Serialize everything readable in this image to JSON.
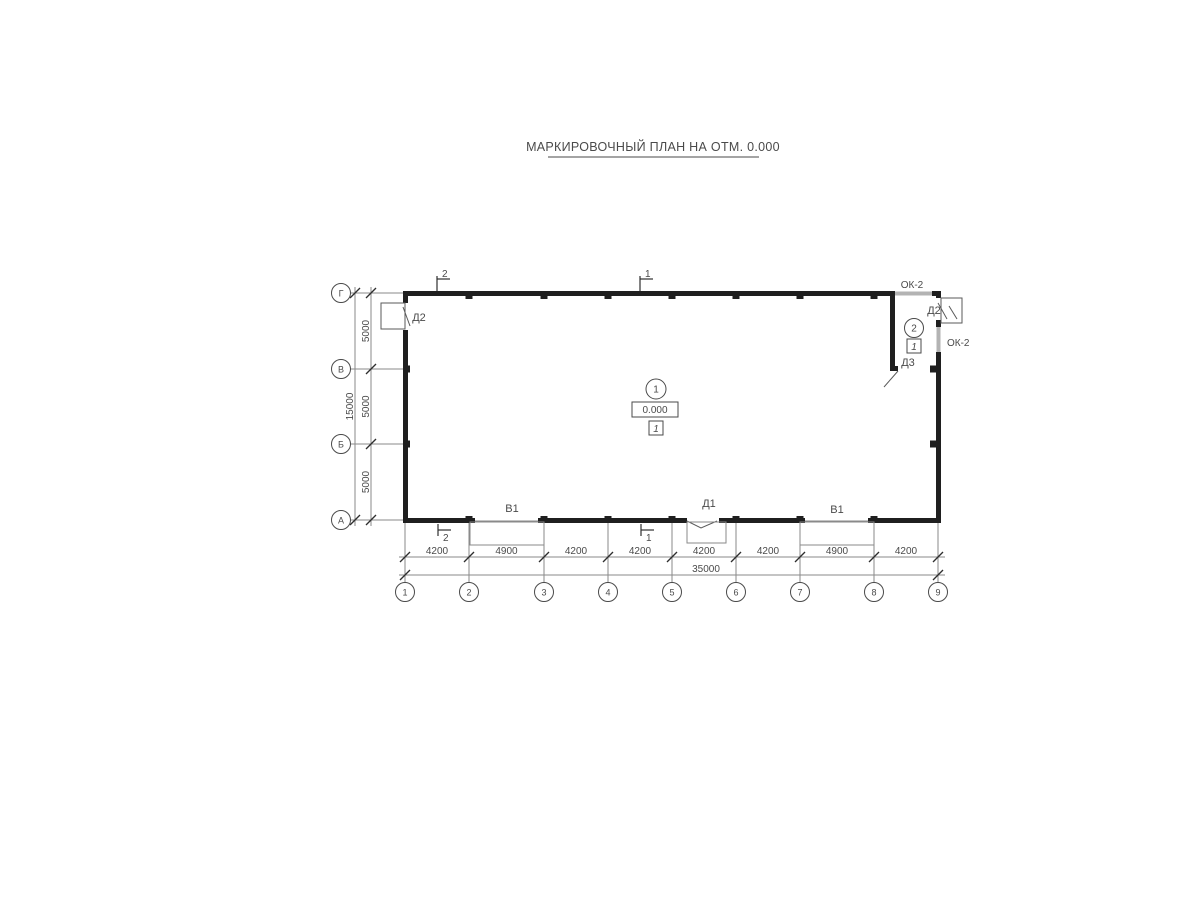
{
  "title": "МАРКИРОВОЧНЫЙ ПЛАН НА ОТМ. 0.000",
  "colors": {
    "wall": "#1f1f1f",
    "window": "#b3b3b3",
    "thin_line": "#8a8a8a",
    "text": "#4a4a4a"
  },
  "grid": {
    "columns": [
      "1",
      "2",
      "3",
      "4",
      "5",
      "6",
      "7",
      "8",
      "9"
    ],
    "rows": [
      "Г",
      "В",
      "Б",
      "А"
    ]
  },
  "dimensions": {
    "bottom": {
      "segments": [
        "4200",
        "4900",
        "4200",
        "4200",
        "4200",
        "4200",
        "4900",
        "4200"
      ],
      "total": "35000"
    },
    "left": {
      "segments": [
        "5000",
        "5000",
        "5000"
      ],
      "total": "15000"
    }
  },
  "sections": {
    "s1": "1",
    "s2": "2"
  },
  "openings": {
    "door_left": "Д2",
    "door_right": "Д2",
    "door_inner": "Д3",
    "door_front": "Д1",
    "gate_left": "В1",
    "gate_right": "В1",
    "window_top": "ОК-2",
    "window_side": "ОК-2"
  },
  "rooms": {
    "hall": {
      "number": "1",
      "elevation": "0.000",
      "type": "1"
    },
    "annex": {
      "number": "2",
      "type": "1"
    }
  }
}
